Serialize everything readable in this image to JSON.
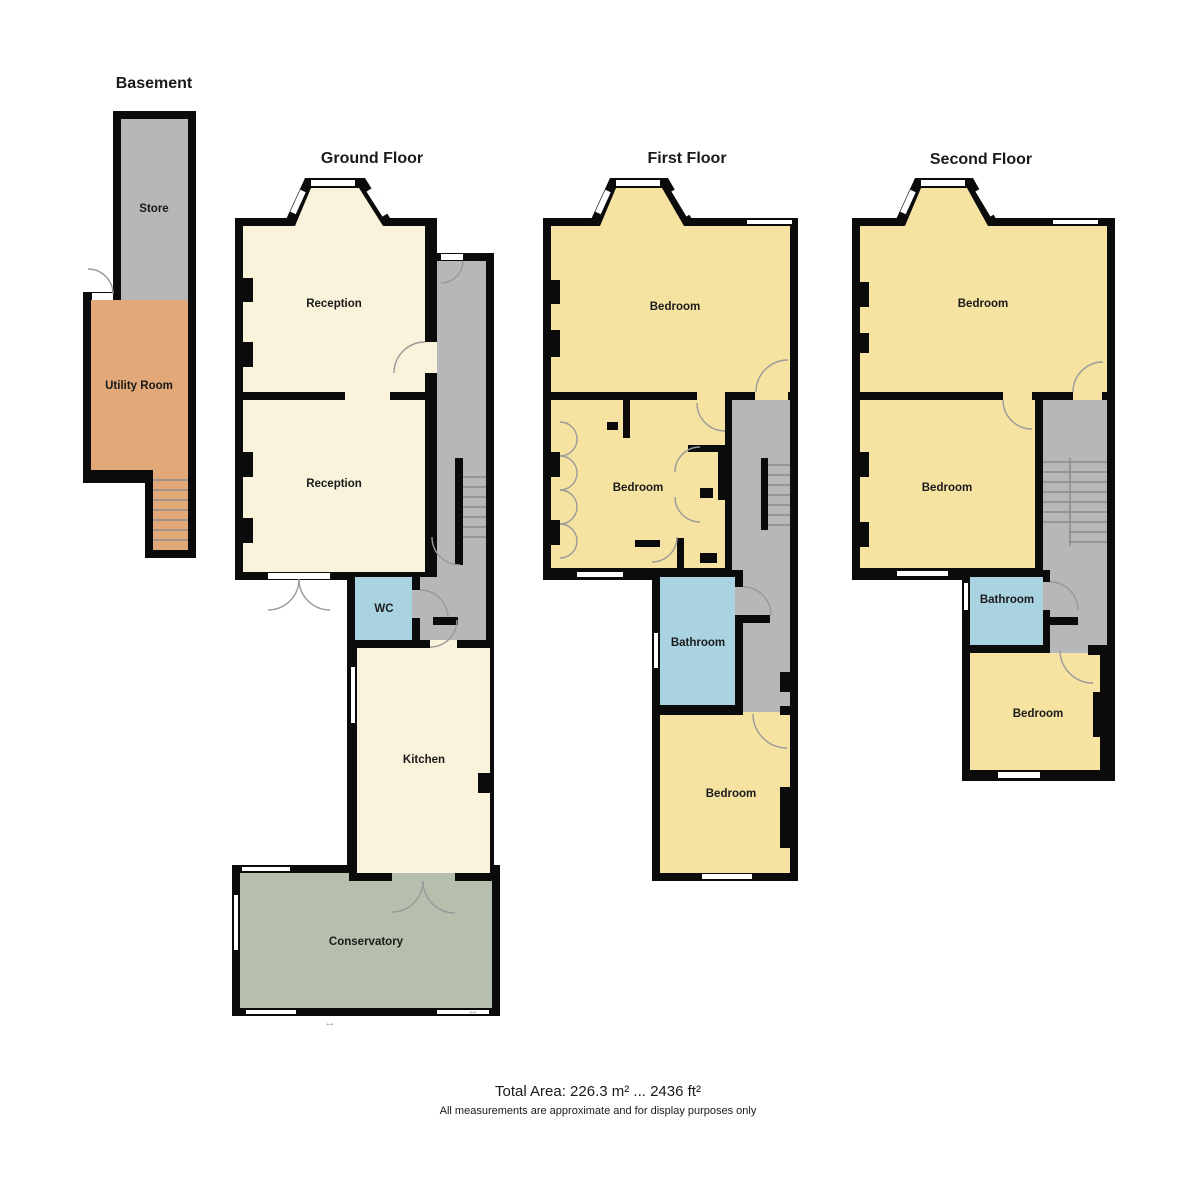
{
  "floors": [
    {
      "name": "Basement",
      "rooms": [
        {
          "label": "Store"
        },
        {
          "label": "Utility Room"
        }
      ]
    },
    {
      "name": "Ground Floor",
      "rooms": [
        {
          "label": "Reception"
        },
        {
          "label": "Reception"
        },
        {
          "label": "WC"
        },
        {
          "label": "Kitchen"
        },
        {
          "label": "Conservatory"
        }
      ]
    },
    {
      "name": "First Floor",
      "rooms": [
        {
          "label": "Bedroom"
        },
        {
          "label": "Bedroom"
        },
        {
          "label": "Bathroom"
        },
        {
          "label": "Bedroom"
        }
      ]
    },
    {
      "name": "Second Floor",
      "rooms": [
        {
          "label": "Bedroom"
        },
        {
          "label": "Bedroom"
        },
        {
          "label": "Bathroom"
        },
        {
          "label": "Bedroom"
        }
      ]
    }
  ],
  "footer": {
    "total_area": "Total Area: 226.3 m² ... 2436 ft²",
    "disclaimer": "All measurements are approximate and for display purposes only"
  },
  "slide_marker": "↔",
  "colors": {
    "wall": "#0b0b0b",
    "room_cream": "#f8f3da",
    "room_bedroom": "#f6e3a2",
    "room_hall": "#b7b7b9",
    "room_utility": "#e2a878",
    "room_bath": "#aad3e2",
    "room_conservatory": "#b6bfad",
    "window_fill": "#ffffff",
    "stair_line": "#8a8a8a",
    "door_arc": "#999999",
    "text": "#1a1a1a"
  }
}
